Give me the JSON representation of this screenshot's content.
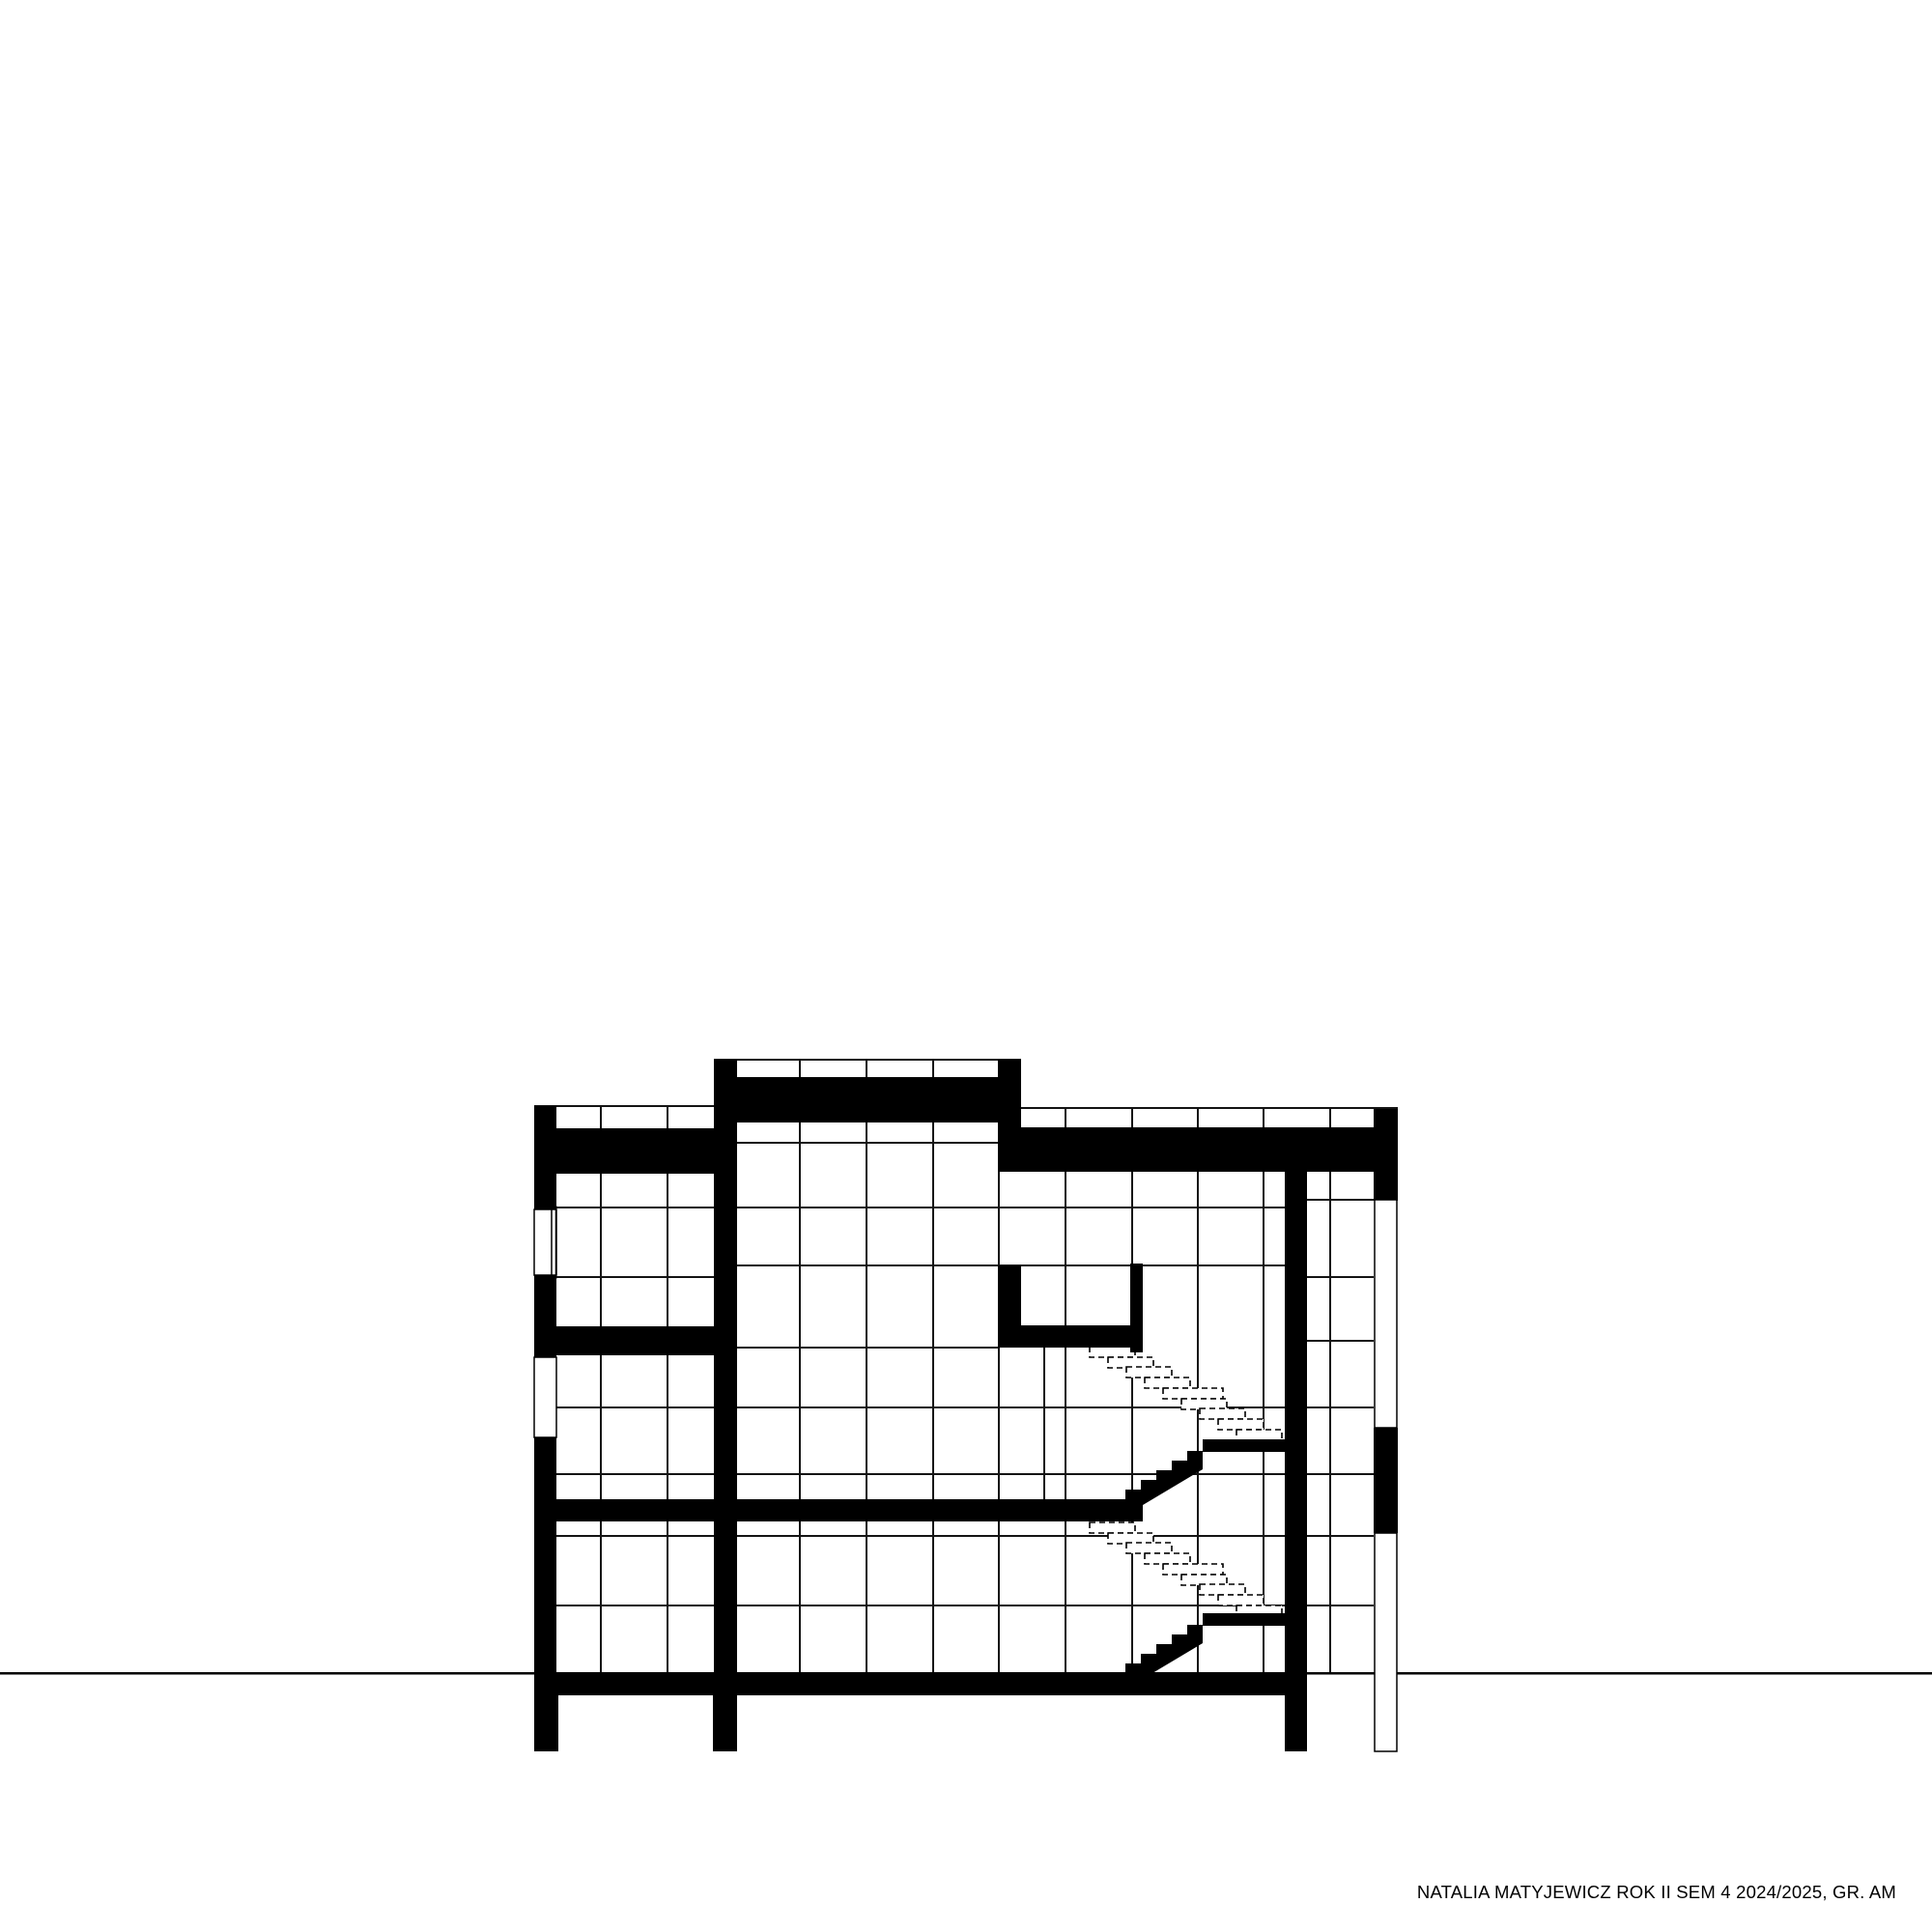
{
  "document": {
    "kind": "architectural cross-section drawing",
    "caption": "NATALIA MATYJEWICZ ROK II SEM 4 2024/2025, GR. AM"
  },
  "colors": {
    "paper": "#ffffff",
    "ink": "#000000",
    "grid_line": "#141414"
  },
  "drawing": {
    "elements": [
      "ground-line",
      "facade-grid",
      "left-wing-walls-and-slabs",
      "central-raised-roof-block",
      "right-wing-roof-slab",
      "stair-core-wall",
      "upper-stair-flight-solid",
      "upper-stair-flight-dashed",
      "lower-stair-flight-solid",
      "lower-stair-flight-dashed",
      "stair-landings",
      "wall-window-openings",
      "foundation-columns"
    ]
  }
}
